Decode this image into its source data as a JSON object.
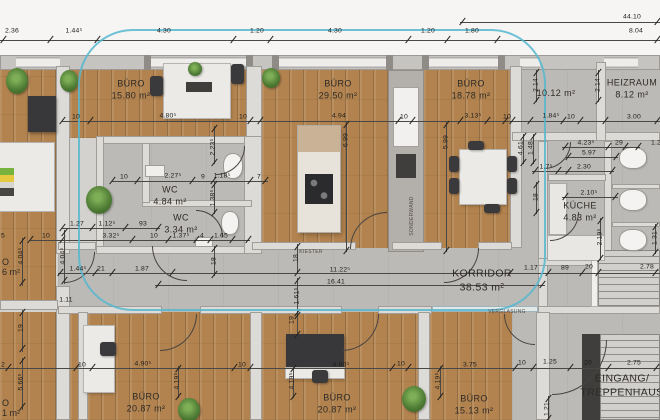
{
  "colors": {
    "highlight": "#56b7cf",
    "wood_floor": "#b2834f",
    "concrete_floor": "#bcbab7",
    "wall": "#dddbd7",
    "dim_text": "#1e1c1a"
  },
  "rooms": [
    {
      "id": "buero-1",
      "name": "BÜRO",
      "area": "15.80 m²",
      "x": 131,
      "y": 90
    },
    {
      "id": "buero-2",
      "name": "BÜRO",
      "area": "29.50 m²",
      "x": 338,
      "y": 90
    },
    {
      "id": "buero-3",
      "name": "BÜRO",
      "area": "18.78 m²",
      "x": 471,
      "y": 90
    },
    {
      "id": "raum-1012",
      "name": "",
      "area": "10.12 m²",
      "x": 556,
      "y": 94
    },
    {
      "id": "heizraum",
      "name": "HEIZRAUM",
      "area": "8.12 m²",
      "x": 632,
      "y": 89
    },
    {
      "id": "wc-1",
      "name": "WC",
      "area": "4.84 m²",
      "x": 170,
      "y": 196
    },
    {
      "id": "wc-2",
      "name": "WC",
      "area": "3.34 m²",
      "x": 181,
      "y": 224
    },
    {
      "id": "kueche",
      "name": "KÜCHE",
      "area": "4.83 m²",
      "x": 580,
      "y": 212
    },
    {
      "id": "korridor",
      "name": "KORRIDOR",
      "area": "38.53 m²",
      "x": 482,
      "y": 281,
      "big": true
    },
    {
      "id": "buero-4",
      "name": "BÜRO",
      "area": "20.87 m²",
      "x": 146,
      "y": 403
    },
    {
      "id": "buero-5",
      "name": "BÜRO",
      "area": "20.87 m²",
      "x": 337,
      "y": 404
    },
    {
      "id": "buero-6",
      "name": "BÜRO",
      "area": "15.13 m²",
      "x": 474,
      "y": 405
    },
    {
      "id": "eingang-treppenhaus",
      "name": "EINGANG/",
      "area": "TREPPENHAUS",
      "x": 622,
      "y": 386,
      "big": true
    }
  ],
  "clipped_labels": [
    {
      "text": "O",
      "x": 2,
      "y": 257
    },
    {
      "text": "6 m²",
      "x": 2,
      "y": 267
    },
    {
      "text": "O",
      "x": 2,
      "y": 398
    },
    {
      "text": "1 m²",
      "x": 2,
      "y": 408
    }
  ],
  "annotations": [
    {
      "text": "VERGLASUNG",
      "x": 507,
      "y": 312
    },
    {
      "text": "KIESTER",
      "x": 311,
      "y": 252
    },
    {
      "text": "SONDERWAND",
      "x": 412,
      "y": 216,
      "vertical": true
    }
  ],
  "dimensions": [
    {
      "t": "44.10",
      "x": 632,
      "y": 17
    },
    {
      "t": "2.36",
      "x": 12,
      "y": 31
    },
    {
      "t": "1.44⁵",
      "x": 74,
      "y": 31
    },
    {
      "t": "4.30",
      "x": 164,
      "y": 31
    },
    {
      "t": "1.20",
      "x": 257,
      "y": 31
    },
    {
      "t": "4.30",
      "x": 335,
      "y": 31
    },
    {
      "t": "1.20",
      "x": 428,
      "y": 31
    },
    {
      "t": "1.80",
      "x": 472,
      "y": 31
    },
    {
      "t": "8.04",
      "x": 636,
      "y": 31
    },
    {
      "t": "10",
      "x": 76,
      "y": 117
    },
    {
      "t": "4.80⁵",
      "x": 168,
      "y": 116
    },
    {
      "t": "10",
      "x": 243,
      "y": 117
    },
    {
      "t": "4.94",
      "x": 339,
      "y": 116
    },
    {
      "t": "10",
      "x": 404,
      "y": 117
    },
    {
      "t": "3.13⁵",
      "x": 473,
      "y": 116
    },
    {
      "t": "10",
      "x": 507,
      "y": 117
    },
    {
      "t": "1.84⁵",
      "x": 551,
      "y": 116
    },
    {
      "t": "10",
      "x": 571,
      "y": 117
    },
    {
      "t": "3.00",
      "x": 634,
      "y": 117
    },
    {
      "t": "2.14",
      "x": 536,
      "y": 85,
      "v": true
    },
    {
      "t": "2.14",
      "x": 598,
      "y": 85,
      "v": true
    },
    {
      "t": "4.61",
      "x": 521,
      "y": 148,
      "v": true
    },
    {
      "t": "1.48",
      "x": 531,
      "y": 148,
      "v": true
    },
    {
      "t": "18",
      "x": 536,
      "y": 197,
      "v": true
    },
    {
      "t": "6.99",
      "x": 346,
      "y": 140,
      "v": true
    },
    {
      "t": "5.99",
      "x": 446,
      "y": 142,
      "v": true
    },
    {
      "t": "2.23⁵",
      "x": 213,
      "y": 147,
      "v": true
    },
    {
      "t": "4.23⁵",
      "x": 586,
      "y": 143
    },
    {
      "t": "29",
      "x": 619,
      "y": 143
    },
    {
      "t": "1.2",
      "x": 656,
      "y": 143
    },
    {
      "t": "5.97",
      "x": 589,
      "y": 153
    },
    {
      "t": "2.30",
      "x": 584,
      "y": 167
    },
    {
      "t": "1.7⁵",
      "x": 546,
      "y": 167
    },
    {
      "t": "2.10⁵",
      "x": 589,
      "y": 193
    },
    {
      "t": "2.19⁵",
      "x": 600,
      "y": 237,
      "v": true
    },
    {
      "t": "1.31",
      "x": 655,
      "y": 238,
      "v": true
    },
    {
      "t": "10",
      "x": 124,
      "y": 177
    },
    {
      "t": "2.27⁵",
      "x": 173,
      "y": 176
    },
    {
      "t": "9",
      "x": 203,
      "y": 177
    },
    {
      "t": "1.18⁵",
      "x": 222,
      "y": 176
    },
    {
      "t": "7",
      "x": 259,
      "y": 177
    },
    {
      "t": "1.38⁵",
      "x": 213,
      "y": 198,
      "v": true
    },
    {
      "t": "1.27",
      "x": 77,
      "y": 224
    },
    {
      "t": "1.12⁵",
      "x": 107,
      "y": 224
    },
    {
      "t": "93",
      "x": 143,
      "y": 224
    },
    {
      "t": "5",
      "x": 3,
      "y": 236
    },
    {
      "t": "10",
      "x": 46,
      "y": 236
    },
    {
      "t": "3.32⁵",
      "x": 111,
      "y": 236
    },
    {
      "t": "10",
      "x": 154,
      "y": 236
    },
    {
      "t": "1.37⁵",
      "x": 181,
      "y": 236
    },
    {
      "t": "4",
      "x": 202,
      "y": 236
    },
    {
      "t": "1.65",
      "x": 221,
      "y": 236
    },
    {
      "t": "4.04⁵",
      "x": 21,
      "y": 256,
      "v": true
    },
    {
      "t": "4.04⁵",
      "x": 63,
      "y": 256,
      "v": true
    },
    {
      "t": "1.44⁵",
      "x": 78,
      "y": 269
    },
    {
      "t": "21",
      "x": 101,
      "y": 269
    },
    {
      "t": "1.87",
      "x": 142,
      "y": 269
    },
    {
      "t": "11.22⁵",
      "x": 340,
      "y": 270
    },
    {
      "t": "16.41",
      "x": 336,
      "y": 282
    },
    {
      "t": "18",
      "x": 214,
      "y": 261,
      "v": true
    },
    {
      "t": "18",
      "x": 296,
      "y": 258,
      "v": true
    },
    {
      "t": "1.61⁵",
      "x": 297,
      "y": 296,
      "v": true
    },
    {
      "t": "19",
      "x": 292,
      "y": 320,
      "v": true
    },
    {
      "t": "1.11",
      "x": 66,
      "y": 300
    },
    {
      "t": "1.17",
      "x": 531,
      "y": 268
    },
    {
      "t": "89",
      "x": 565,
      "y": 268
    },
    {
      "t": "20",
      "x": 589,
      "y": 267
    },
    {
      "t": "2.78",
      "x": 647,
      "y": 267
    },
    {
      "t": "19",
      "x": 21,
      "y": 328,
      "v": true
    },
    {
      "t": "5.66⁵",
      "x": 21,
      "y": 382,
      "v": true
    },
    {
      "t": "2",
      "x": 3,
      "y": 365
    },
    {
      "t": "10",
      "x": 82,
      "y": 365
    },
    {
      "t": "4.90⁵",
      "x": 143,
      "y": 364
    },
    {
      "t": "10",
      "x": 242,
      "y": 365
    },
    {
      "t": "4.90⁵",
      "x": 341,
      "y": 365
    },
    {
      "t": "10",
      "x": 401,
      "y": 364
    },
    {
      "t": "3.75",
      "x": 470,
      "y": 365
    },
    {
      "t": "10",
      "x": 522,
      "y": 363
    },
    {
      "t": "1.25",
      "x": 550,
      "y": 362
    },
    {
      "t": "20",
      "x": 588,
      "y": 363
    },
    {
      "t": "2.75",
      "x": 634,
      "y": 363
    },
    {
      "t": "4.19⁵",
      "x": 177,
      "y": 381,
      "v": true
    },
    {
      "t": "4.19⁵",
      "x": 292,
      "y": 381,
      "v": true
    },
    {
      "t": "4.19⁵",
      "x": 438,
      "y": 381,
      "v": true
    },
    {
      "t": "1.21",
      "x": 547,
      "y": 409,
      "v": true
    }
  ]
}
